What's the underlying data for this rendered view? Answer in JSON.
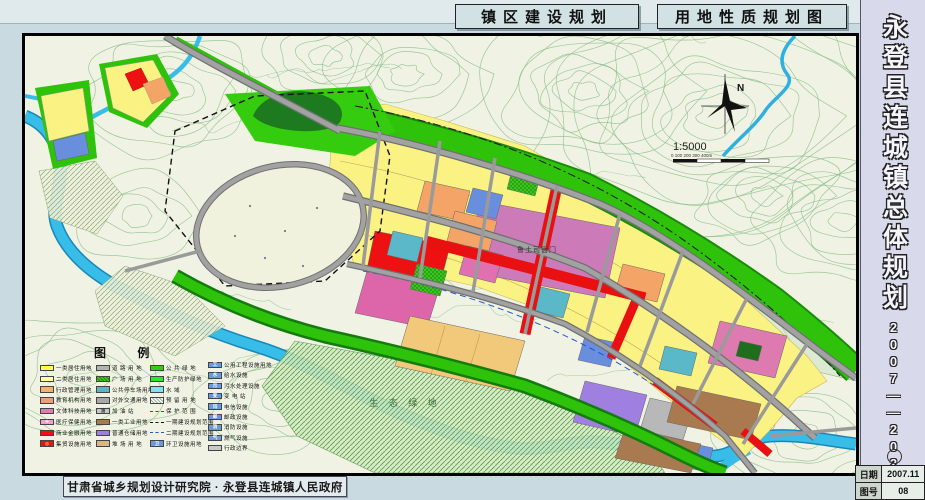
{
  "header": {
    "left_title": "镇区建设规划",
    "right_title": "用地性质规划图"
  },
  "titleblock": {
    "vertical_title": "永登县连城镇总体规划",
    "vertical_years": "2007——2020",
    "rows": [
      {
        "label": "日期",
        "value": "2007.11"
      },
      {
        "label": "图号",
        "value": "08"
      }
    ]
  },
  "footer": {
    "credit": "甘肃省城乡规划设计研究院 · 永登县连城镇人民政府"
  },
  "map": {
    "labels": {
      "heritage_site": "鲁土司衙门",
      "eco_green": "生 态 绿 地",
      "north": "N",
      "scale_text": "1:5000",
      "scale_bar": "0     100    200    300   400m"
    },
    "colors": {
      "residential_yellow": "#faf282",
      "commercial_red": "#ee1111",
      "heritage_pink": "#cc7ab8",
      "water_blue": "#38bce8",
      "green_belt": "#2ec20a",
      "road_gray": "#9a9a9a"
    },
    "legend": {
      "title": "图  例",
      "columns": [
        [
          {
            "sw": {
              "t": "f",
              "c": "#ffff4d"
            },
            "label": "一类居住用地"
          },
          {
            "sw": {
              "t": "f",
              "c": "#ffff9e"
            },
            "label": "二类居住用地"
          },
          {
            "sw": {
              "t": "f",
              "c": "#f6b06e"
            },
            "label": "行政管理用地"
          },
          {
            "sw": {
              "t": "f",
              "c": "#f09a78"
            },
            "label": "教育机构用地"
          },
          {
            "sw": {
              "t": "f",
              "c": "#e27ab4"
            },
            "label": "文体科技用地"
          },
          {
            "sw": {
              "t": "f",
              "c": "#f2a0c8",
              "sym": "✚"
            },
            "label": "医疗保健用地"
          },
          {
            "sw": {
              "t": "f",
              "c": "#ee1111"
            },
            "label": "商业金融用地"
          },
          {
            "sw": {
              "t": "f",
              "c": "#ee1111",
              "sym": "◎"
            },
            "label": "集贸设施用地"
          }
        ],
        [
          {
            "sw": {
              "t": "f",
              "c": "#b3b3b3"
            },
            "label": "道 路 用 地"
          },
          {
            "sw": {
              "t": "ch"
            },
            "label": "广 场 用 地"
          },
          {
            "sw": {
              "t": "f",
              "c": "#58b8c0"
            },
            "label": "公共停车场用地"
          },
          {
            "sw": {
              "t": "f",
              "c": "#a8a8a8"
            },
            "label": "对外交通用地"
          },
          {
            "sw": {
              "t": "f",
              "c": "#c6c6c6",
              "sym": "油",
              "dk": true
            },
            "label": "加  油  站"
          },
          {
            "sw": {
              "t": "f",
              "c": "#aa7a50"
            },
            "label": "一类工业用地"
          },
          {
            "sw": {
              "t": "f",
              "c": "#9f80e0"
            },
            "label": "普通仓储用地"
          },
          {
            "sw": {
              "t": "f",
              "c": "#d9b878"
            },
            "label": "堆 场 用 地"
          }
        ],
        [
          {
            "sw": {
              "t": "f",
              "c": "#33cc11"
            },
            "label": "公 共 绿 地"
          },
          {
            "sw": {
              "t": "f",
              "c": "#22ee22"
            },
            "label": "生产防护绿地"
          },
          {
            "sw": {
              "t": "f",
              "c": "#7ae4f0"
            },
            "label": "水        域"
          },
          {
            "sw": {
              "t": "h"
            },
            "label": "预 留 用 地"
          },
          {
            "sw": {
              "t": "l",
              "ls": "ln-red"
            },
            "label": "保 护 范 围"
          },
          {
            "sw": {
              "t": "l",
              "ls": "ln-bd"
            },
            "label": "一期建设规划范围"
          },
          {
            "sw": {
              "t": "l",
              "ls": "ln-bl"
            },
            "label": "二期建设规划范围"
          },
          {
            "sw": {
              "t": "f",
              "c": "#6a9ade",
              "sym": "卫"
            },
            "label": "环卫设施用地"
          }
        ],
        [
          {
            "sw": {
              "t": "f",
              "c": "#6a9ade",
              "sym": "工"
            },
            "label": "公用工程设施用地"
          },
          {
            "sw": {
              "t": "f",
              "c": "#6a9ade",
              "sym": "水"
            },
            "label": "给水设施"
          },
          {
            "sw": {
              "t": "f",
              "c": "#6a9ade",
              "sym": "污"
            },
            "label": "污水处理设施"
          },
          {
            "sw": {
              "t": "f",
              "c": "#6a9ade",
              "sym": "变"
            },
            "label": "变  电  站"
          },
          {
            "sw": {
              "t": "f",
              "c": "#6a9ade",
              "sym": "讯"
            },
            "label": "电信设施"
          },
          {
            "sw": {
              "t": "f",
              "c": "#6a9ade",
              "sym": "邮"
            },
            "label": "邮政设施"
          },
          {
            "sw": {
              "t": "f",
              "c": "#6a9ade",
              "sym": "消"
            },
            "label": "消防设施"
          },
          {
            "sw": {
              "t": "f",
              "c": "#6a9ade",
              "sym": "气"
            },
            "label": "燃气设施"
          },
          {
            "sw": {
              "t": "f",
              "c": "#c8c8c8"
            },
            "label": "行政边界"
          }
        ]
      ]
    }
  }
}
